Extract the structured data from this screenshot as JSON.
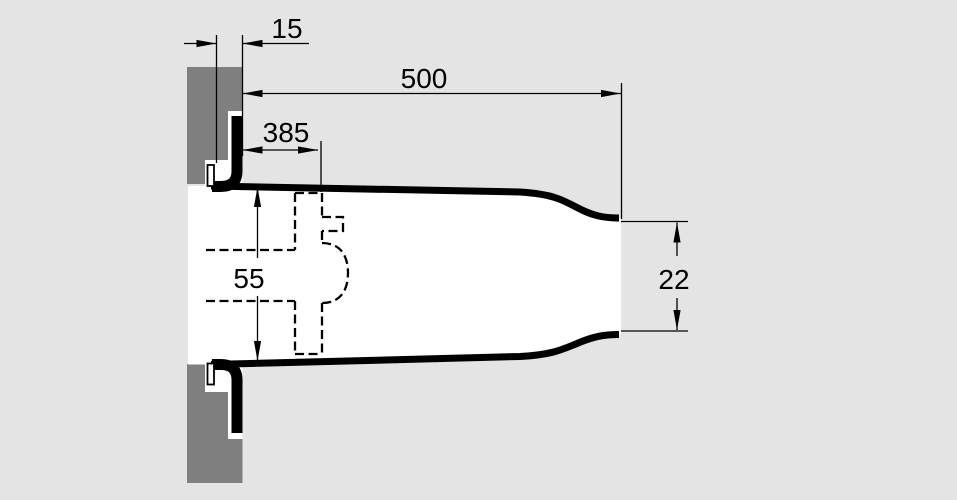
{
  "figure": {
    "kind": "technical-cross-section-drawing",
    "description": "Side cross-section of a duct passing through a wall, with flange mounting plate, hidden internal part shown dashed, and five dimension callouts",
    "colors": {
      "background": "#e4e4e4",
      "wall": "#7f7f7f",
      "duct_line": "#000000",
      "interior": "#ffffff",
      "dimension_text": "#000000"
    }
  },
  "dimensions": {
    "flange_offset": {
      "value": "15"
    },
    "total_length": {
      "value": "500"
    },
    "insertion_depth": {
      "value": "385"
    },
    "duct_inner_height": {
      "value": "55"
    },
    "outlet_height": {
      "value": "22"
    }
  }
}
